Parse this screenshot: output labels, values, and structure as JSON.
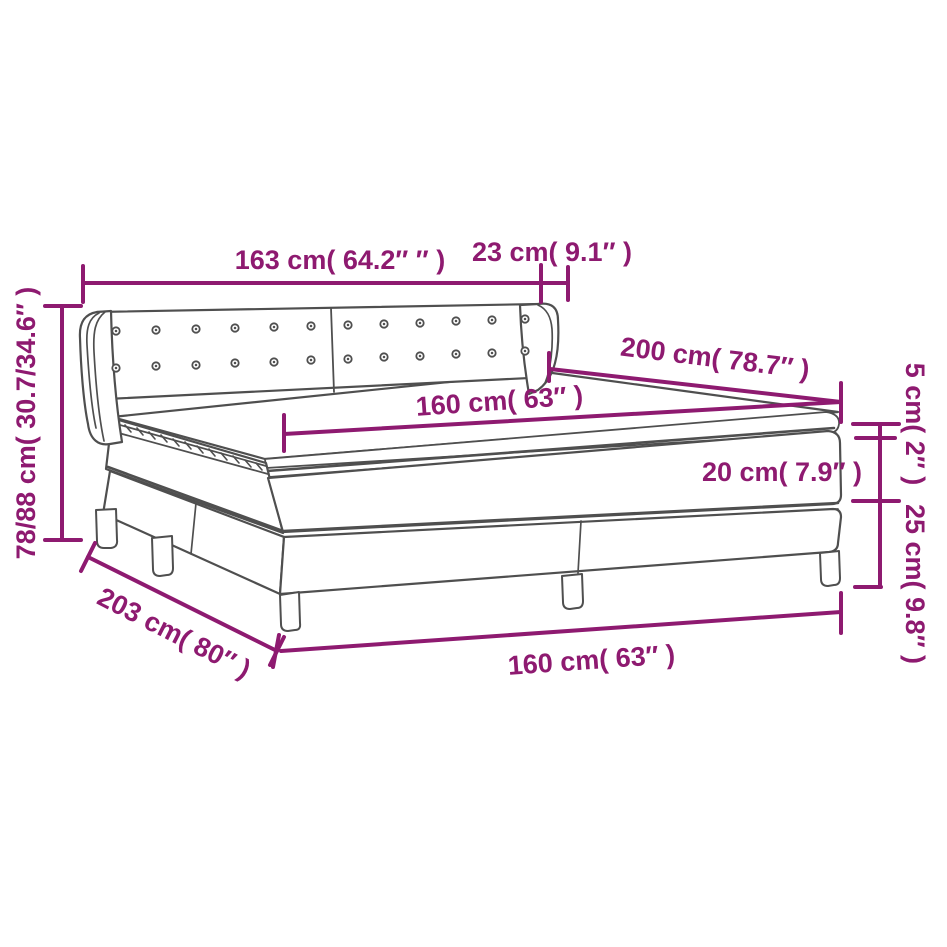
{
  "diagram": {
    "subject": "box-spring-bed-with-tufted-headboard",
    "background": "#ffffff",
    "accent_color": "#8e1a70",
    "outline_color": "#4f4f4f"
  },
  "labels": {
    "headboard_width": "163 cm( 64.2″ ″ )",
    "headboard_side_depth": "23 cm( 9.1″ )",
    "total_height": "78/88 cm( 30.7/34.6″ )",
    "mattress_length": "200 cm( 78.7″ )",
    "mattress_width": "160 cm( 63″ )",
    "topper_height": "5 cm( 2″ )",
    "mattress_height": "20 cm( 7.9″ )",
    "base_height": "25 cm( 9.8″ )",
    "base_length": "203 cm( 80″ )",
    "base_width": "160 cm( 63″ )"
  }
}
